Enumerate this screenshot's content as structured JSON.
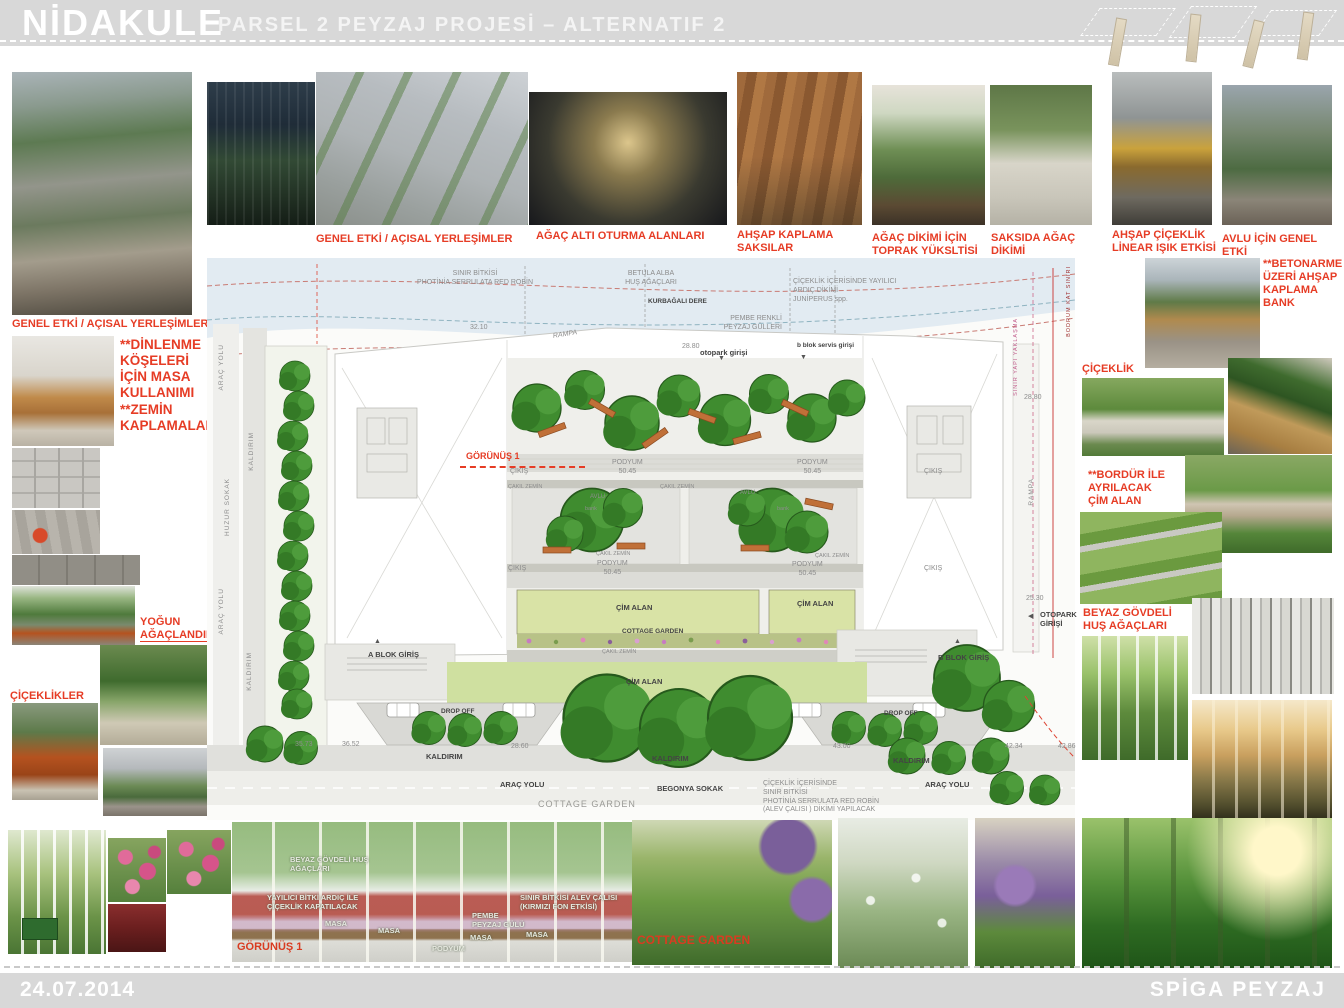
{
  "header": {
    "title": "NİDAKULE",
    "subtitle": "PARSEL 2 PEYZAJ PROJESİ – ALTERNATIF 2"
  },
  "footer": {
    "date": "24.07.2014",
    "company": "SPİGA PEYZAJ"
  },
  "colors": {
    "accent_red": "#e63c25",
    "bar_gray": "#d8d8d8",
    "cad_gray": "#8c8c8c"
  },
  "icons": {
    "arrow_down": "▼",
    "arrow_up": "▲",
    "arrow_left": "◀"
  },
  "captions": [
    "GENEL ETKİ / AÇISAL YERLEŞİMLER",
    "GENEL ETKİ / AÇISAL YERLEŞİMLER",
    "AĞAÇ ALTI OTURMA  ALANLARI",
    "AHŞAP  KAPLAMA\nSAKSILAR",
    "AĞAÇ DİKİMİ İÇİN\nTOPRAK  YÜKSLTİSİ",
    "SAKSIDA AĞAÇ\nDİKİMİ",
    "AHŞAP  ÇİÇEKLİK\nLİNEAR IŞIK ETKİSİ",
    "AVLU  İÇİN GENEL  ETKİ"
  ],
  "left_labels": [
    "**DİNLENME\nKÖŞELERİ\nİÇİN MASA\nKULLANIMI",
    "**ZEMİN\nKAPLAMALAR",
    "YOĞUN\nAĞAÇLANDIRMA",
    "ÇİÇEKLİKLER"
  ],
  "right_labels": [
    "**BETONARME\nÜZERİ  AHŞAP\nKAPLAMA\nBANK",
    "ÇİÇEKLİK",
    "**BORDÜR İLE\nAYRILACAK\nÇİM ALAN",
    "BEYAZ GÖVDELİ\nHUŞ AĞAÇLARI"
  ],
  "plan": {
    "annotations": [
      "SINIR BİTKİSİ\nPHOTİNİA SERRULATA RED ROBİN",
      "BETULA ALBA\nHUŞ AĞAÇLARI",
      "KURBAĞALI DERE",
      "ÇİÇEKLİK İÇERİSİNDE YAYILICI\nARDIÇ DİKİMİ\nJUNİPERUS spp.",
      "PEMBE RENKLİ\nPEYZAJ GÜLLERİ",
      "32.10",
      "RAMPA",
      "28.80",
      "otopark girişi",
      "b blok servis girişi",
      "SINIR YAPI YAKLAŞMA",
      "BODRUM KAT SINIRI",
      "28.80",
      "RAMPA",
      "25.30",
      "OTOPARK\nGİRİŞİ",
      "ARAÇ YOLU",
      "KALDIRIM",
      "HUZUR SOKAK",
      "ARAÇ YOLU",
      "KALDIRIM",
      "GÖRÜNÜŞ 1",
      "ÇIKIŞ",
      "PODYUM\n50.45",
      "PODYUM\n50.45",
      "ÇIKIŞ",
      "ÇAKIL ZEMİN",
      "ÇAKIL ZEMİN",
      "AVLU",
      "AVLU",
      "ÇAKIL ZEMİN",
      "ÇAKIL ZEMİN",
      "ÇIKIŞ",
      "PODYUM\n50.45",
      "PODYUM\n50.45",
      "ÇIKIŞ",
      "ÇİM ALAN",
      "ÇİM ALAN",
      "COTTAGE GARDEN",
      "ÇAKIL ZEMİN",
      "A BLOK GİRİŞ",
      "B BLOK GİRİŞ",
      "ÇİM ALAN",
      "DROP OFF",
      "DROP OFF",
      "KALDIRIM",
      "KALDIRIM",
      "KALDIRIM",
      "ARAÇ YOLU",
      "ARAÇ YOLU",
      "BEGONYA SOKAK",
      "COTTAGE GARDEN",
      "ÇİÇEKLİK İÇERİSİNDE\nSINIR BİTKİSİ\nPHOTİNİA SERRULATA RED ROBİN\n(ALEV ÇALISI ) DİKİMİ YAPILACAK",
      "35.73",
      "36.52",
      "28.60",
      "43.00",
      "42.34",
      "42.86",
      "bank",
      "bank"
    ]
  },
  "section": {
    "labels": [
      "BEYAZ GÖVDELİ HUŞ\nAĞAÇLARI",
      "YAYILICI BİTKİ ARDIÇ  İLE\nÇİÇEKLİK KAPATILACAK",
      "SINIR BİTKİSİ  ALEV ÇALISI\n(KIRMIZI FON ETKİSİ)",
      "PEMBE\nPEYZAJ GÜLÜ",
      "MASA",
      "MASA",
      "MASA",
      "MASA",
      "PODYUM",
      "GÖRÜNÜŞ 1"
    ]
  },
  "bottom": {
    "cottage_garden": "COTTAGE GARDEN"
  }
}
